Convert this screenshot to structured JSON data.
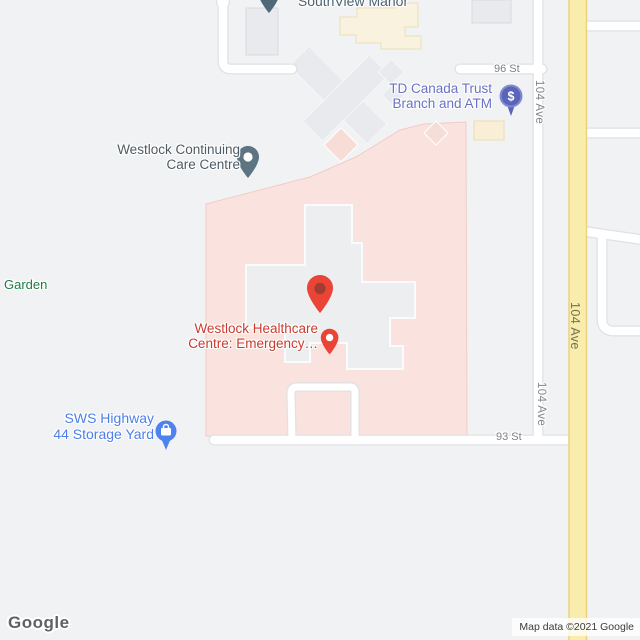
{
  "map_type": "google-maps-roadmap",
  "pois": {
    "southview": {
      "name": "SouthView Manor"
    },
    "td": {
      "line1": "TD Canada Trust",
      "line2": "Branch and ATM"
    },
    "continuing": {
      "line1": "Westlock Continuing",
      "line2": "Care Centre"
    },
    "garden": {
      "name": "Garden"
    },
    "healthcare": {
      "line1": "Westlock Healthcare",
      "line2": "Centre: Emergency…"
    },
    "sws": {
      "line1": "SWS Highway",
      "line2": "44 Storage Yard"
    }
  },
  "streets": {
    "st96": "96 St",
    "st93": "93 St",
    "ave104": "104 Ave"
  },
  "icons": {
    "td_pin_glyph": "$"
  },
  "attribution": {
    "logo": "Google",
    "text": "Map data ©2021 Google"
  },
  "colors": {
    "background": "#f1f2f4",
    "hospital_area_pink": "#fae3de",
    "building_gray": "#e8eaed",
    "building_cream": "#f9f2de",
    "highway_yellow": "#f8edaa",
    "highway_border": "#ecd07e",
    "road_white": "#ffffff",
    "road_casing": "#dfe1e5",
    "marker_red": "#e94436",
    "marker_inner_red": "#a13c32",
    "poi_text_red": "#c93a2e",
    "poi_text_blue": "#4c7fe9",
    "poi_text_purple": "#6a71c5",
    "poi_text_green": "#1d7c42",
    "poi_text_slate": "#4e5b64",
    "pin_slate": "#5d7482",
    "pin_purple": "#5a65ba",
    "pin_blue": "#4e82ee"
  }
}
